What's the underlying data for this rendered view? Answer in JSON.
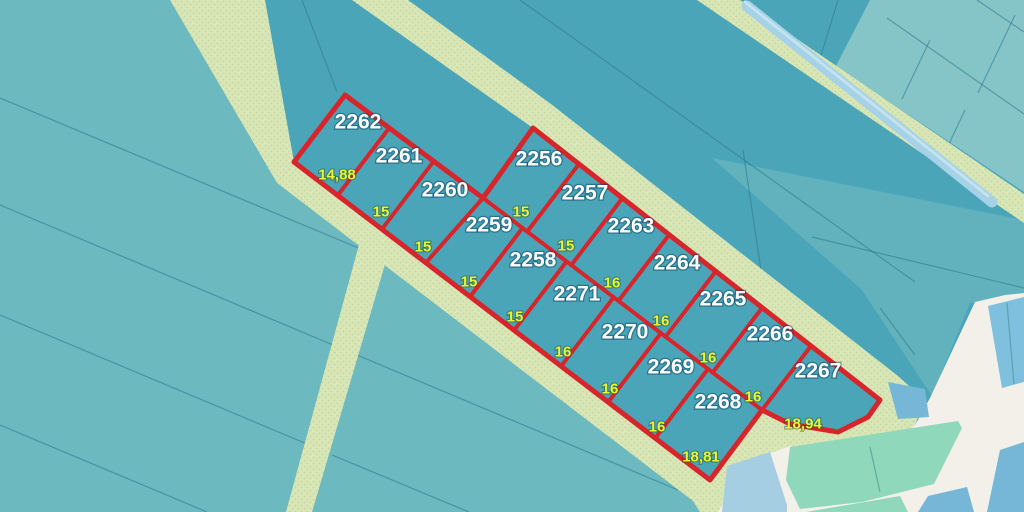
{
  "map": {
    "type": "cadastral-parcel-map",
    "colors": {
      "base_teal": "#4BA5B9",
      "block_interior": "#47A2B7",
      "sw_zone": "#6CB9BF",
      "ne_zone": "#85C4C7",
      "se_patch": "#61B2BC",
      "road": "#D9E6B7",
      "road_dots": "#C6DAA0",
      "boundary_red": "#D6262B",
      "label_white": "#FFFFFF",
      "label_yellow": "#E7F636",
      "white_zone": "#F2F0E9",
      "mint_building": "#8FD8BB",
      "blue_building": "#76B7D7",
      "light_blue_building": "#A6CEE3",
      "blue_building_alt": "#7EC0DD",
      "canal_blue": "#A5D2E6",
      "canal_highlight": "#C9E5F1"
    },
    "parcels": [
      {
        "number": "2262",
        "num_x": 358,
        "num_y": 122,
        "width_label": "14,88",
        "w_x": 337,
        "w_y": 175
      },
      {
        "number": "2261",
        "num_x": 399,
        "num_y": 156,
        "width_label": "15",
        "w_x": 381,
        "w_y": 212
      },
      {
        "number": "2260",
        "num_x": 445,
        "num_y": 190,
        "width_label": "15",
        "w_x": 423,
        "w_y": 247
      },
      {
        "number": "2259",
        "num_x": 489,
        "num_y": 225,
        "width_label": "15",
        "w_x": 469,
        "w_y": 282
      },
      {
        "number": "2258",
        "num_x": 533,
        "num_y": 260,
        "width_label": "15",
        "w_x": 515,
        "w_y": 317
      },
      {
        "number": "2271",
        "num_x": 577,
        "num_y": 294,
        "width_label": "16",
        "w_x": 563,
        "w_y": 352
      },
      {
        "number": "2270",
        "num_x": 625,
        "num_y": 332,
        "width_label": "16",
        "w_x": 610,
        "w_y": 389
      },
      {
        "number": "2269",
        "num_x": 671,
        "num_y": 367,
        "width_label": "16",
        "w_x": 657,
        "w_y": 427
      },
      {
        "number": "2268",
        "num_x": 718,
        "num_y": 402,
        "width_label": "18,81",
        "w_x": 701,
        "w_y": 457
      },
      {
        "number": "2256",
        "num_x": 539,
        "num_y": 159,
        "width_label": "15",
        "w_x": 521,
        "w_y": 212
      },
      {
        "number": "2257",
        "num_x": 585,
        "num_y": 193,
        "width_label": "15",
        "w_x": 566,
        "w_y": 246
      },
      {
        "number": "2263",
        "num_x": 631,
        "num_y": 226,
        "width_label": "16",
        "w_x": 612,
        "w_y": 283
      },
      {
        "number": "2264",
        "num_x": 677,
        "num_y": 263,
        "width_label": "16",
        "w_x": 661,
        "w_y": 321
      },
      {
        "number": "2265",
        "num_x": 723,
        "num_y": 299,
        "width_label": "16",
        "w_x": 708,
        "w_y": 358
      },
      {
        "number": "2266",
        "num_x": 770,
        "num_y": 334,
        "width_label": "16",
        "w_x": 753,
        "w_y": 397
      },
      {
        "number": "2267",
        "num_x": 818,
        "num_y": 371,
        "width_label": "18,94",
        "w_x": 803,
        "w_y": 424
      }
    ]
  }
}
